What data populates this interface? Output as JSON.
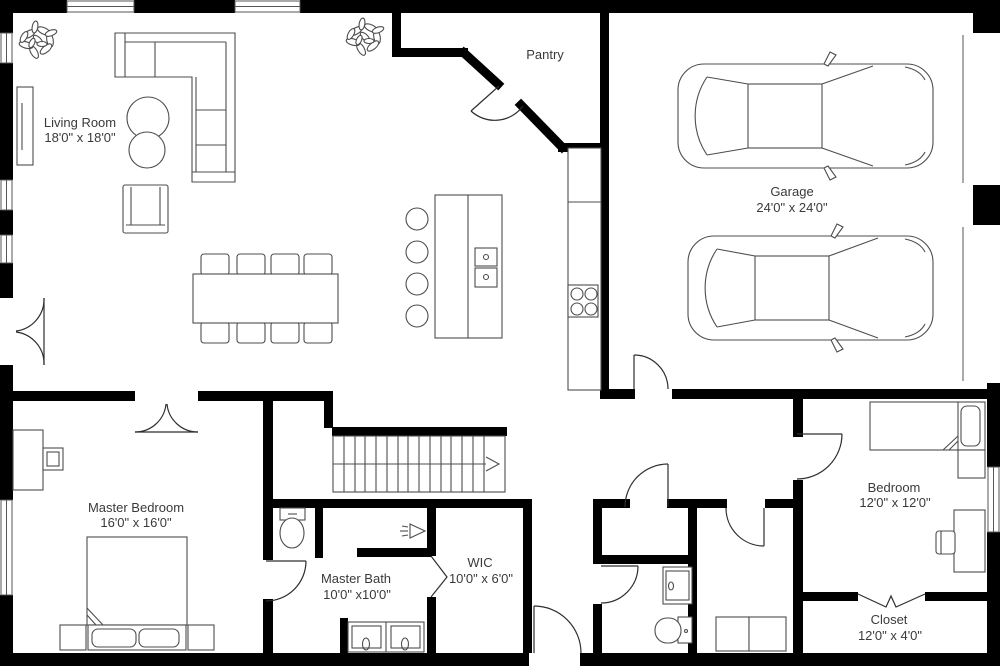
{
  "title": "First Floor Plan",
  "rooms": {
    "living_room": {
      "name": "Living Room",
      "dims": "18'0\" x 18'0\""
    },
    "pantry": {
      "name": "Pantry",
      "dims": ""
    },
    "garage": {
      "name": "Garage",
      "dims": "24'0\" x 24'0\""
    },
    "master_bedroom": {
      "name": "Master Bedroom",
      "dims": "16'0\" x 16'0\""
    },
    "master_bath": {
      "name": "Master Bath",
      "dims": "10'0\" x10'0\""
    },
    "wic": {
      "name": "WIC",
      "dims": "10'0\" x 6'0\""
    },
    "bedroom": {
      "name": "Bedroom",
      "dims": "12'0\" x 12'0\""
    },
    "closet": {
      "name": "Closet",
      "dims": "12'0\" x 4'0\""
    }
  },
  "colors": {
    "wall": "#000000",
    "furniture_line": "#4d4d4d",
    "text": "#3a3a3a",
    "background": "#ffffff"
  }
}
